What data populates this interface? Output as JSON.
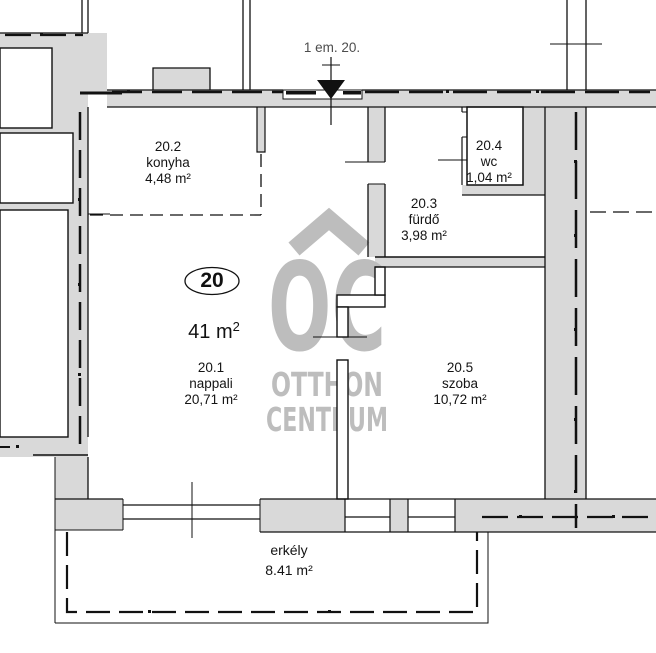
{
  "header": {
    "title": "1 em. 20."
  },
  "unit": {
    "number": "20",
    "total_area_value": "41 m",
    "total_area_sup": "2"
  },
  "rooms": [
    {
      "id": "20.2",
      "name": "konyha",
      "area": "4,48 m²"
    },
    {
      "id": "20.4",
      "name": "wc",
      "area": "1,04 m²"
    },
    {
      "id": "20.3",
      "name": "fürdő",
      "area": "3,98 m²"
    },
    {
      "id": "20.1",
      "name": "nappali",
      "area": "20,71 m²"
    },
    {
      "id": "20.5",
      "name": "szoba",
      "area": "10,72 m²"
    }
  ],
  "balcony": {
    "name": "erkély",
    "area": "8.41 m²"
  },
  "watermark": {
    "logo": "OC",
    "line1": "OTTHON",
    "line2": "CENTRUM"
  },
  "colors": {
    "wall_fill": "#d9d9d9",
    "line": "#111111",
    "watermark": "#bdbdbd",
    "header_text": "#4d4d4d",
    "label_text": "#141414"
  }
}
